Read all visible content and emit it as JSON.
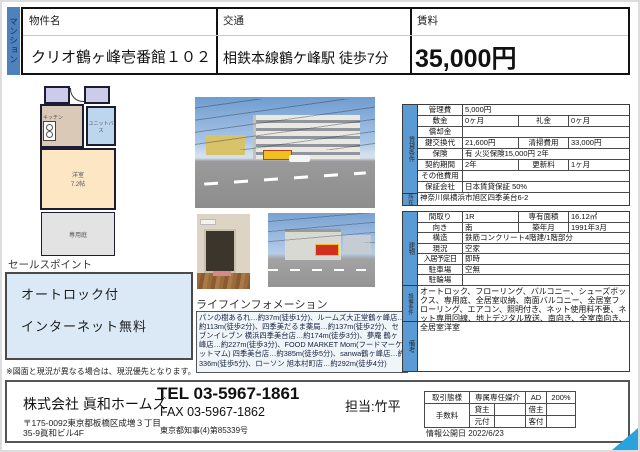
{
  "tab": {
    "label": "マンション"
  },
  "header": {
    "property_label": "物件名",
    "property_name": "クリオ鶴ヶ峰壱番館１０２",
    "access_label": "交通",
    "access_value": "相鉄本線鶴ケ峰駅 徒歩7分",
    "rent_label": "賃料",
    "rent_value": "35,000円"
  },
  "floor_plan": {
    "kitchen_label": "キッチン",
    "bath_label": "ユニットバス",
    "room_label": "洋室",
    "room_size": "7.2帖",
    "garden_label": "専用庭"
  },
  "sales": {
    "title": "セールスポイント",
    "point1": "オートロック付",
    "point2": "インターネット無料"
  },
  "life_info": {
    "title": "ライフインフォメーション",
    "text": "パンの樹あるれ…約37m(徒歩1分)、ルームズ大正堂鶴ヶ峰店…約113m(徒歩2分)、四季美だるま薬局…約137m(徒歩2分)、セブンイレブン 横浜四季美台店…約174m(徒歩3分)、夢庵 鶴ヶ峰店…約227m(徒歩3分)、FOOD MARKET Mom(フードマーケットマム) 四季美台店…約385m(徒歩5分)、sanwa鶴ヶ峰店…約336m(徒歩5分)、ローソン 旭本村町店…約292m(徒歩4分)"
  },
  "details": {
    "section_rental": "賃貸条件",
    "section_location": "所在",
    "section_building": "建物",
    "section_equipment": "設備条件",
    "section_remarks": "備考",
    "mgmt_label": "管理費",
    "mgmt_value": "5,000円",
    "deposit_label": "敷金",
    "deposit_value": "0ヶ月",
    "keymoney_label": "礼金",
    "keymoney_value": "0ヶ月",
    "amort_label": "償却金",
    "amort_value": "",
    "keyex_label": "鍵交換代",
    "keyex_value": "21,600円",
    "cleaning_label": "清掃費用",
    "cleaning_value": "33,000円",
    "insurance_label": "保険",
    "insurance_value": "有 火災保険15,000円 2年",
    "contract_label": "契約期間",
    "contract_value": "2年",
    "renewal_label": "更新料",
    "renewal_value": "1ヶ月",
    "otherfee_label": "その他費用",
    "otherfee_value": "",
    "guarantor_label": "保証会社",
    "guarantor_value": "日本賃貸保証 50%",
    "address": "神奈川県横浜市旭区四季美台6-2",
    "madori_label": "間取り",
    "madori_value": "1R",
    "area_label": "専有面積",
    "area_value": "16.12㎡",
    "muki_label": "向き",
    "muki_value": "南",
    "built_label": "築年月",
    "built_value": "1991年3月",
    "kozo_label": "構造",
    "kozo_value": "鉄筋コンクリート4階建/1階部分",
    "genkyo_label": "現況",
    "genkyo_value": "空家",
    "nyukyo_label": "入居予定日",
    "nyukyo_value": "即時",
    "parking_label": "駐車場",
    "parking_value": "空無",
    "bicycle_label": "駐輪場",
    "bicycle_value": "",
    "equipment_text": "オートロック、フローリング、バルコニー、シューズボックス、専用庭、全居室収納、南面バルコニー、全居室フローリング、エアコン、照明付き、ネット使用料不要、ネット専用回線、地上デジタル放送、南向き、全室南向き、全居室洋室"
  },
  "disclaimer": "※図面と現況が異なる場合は、現況優先となります。",
  "footer": {
    "company": "株式会社 眞和ホームズ",
    "postal_address1": "〒175-0092東京都板橋区成増３丁目",
    "postal_address2": "35-9眞和ビル4F",
    "tel": "TEL 03-5967-1861",
    "fax": "FAX 03-5967-1862",
    "license": "東京都知事(4)第85339号",
    "agent": "担当:竹平",
    "deal_type_label": "取引態様",
    "deal_type_value": "専属専任媒介",
    "ad_label": "AD",
    "ad_value": "200%",
    "fee_label": "手数料",
    "lessor_label": "貸主",
    "lessor_value": "",
    "motozuke_label": "元付",
    "motozuke_value": "",
    "lessee_label": "借主",
    "lessee_value": "",
    "kyakuzuke_label": "客付",
    "kyakuzuke_value": "",
    "published": "情報公開日 2022/6/23"
  },
  "colors": {
    "tab_blue": "#4f81bd",
    "strip_blue": "#5b9bd5",
    "sales_box_bg": "#dbe9f6",
    "corner_blue": "#2aa3dc"
  }
}
